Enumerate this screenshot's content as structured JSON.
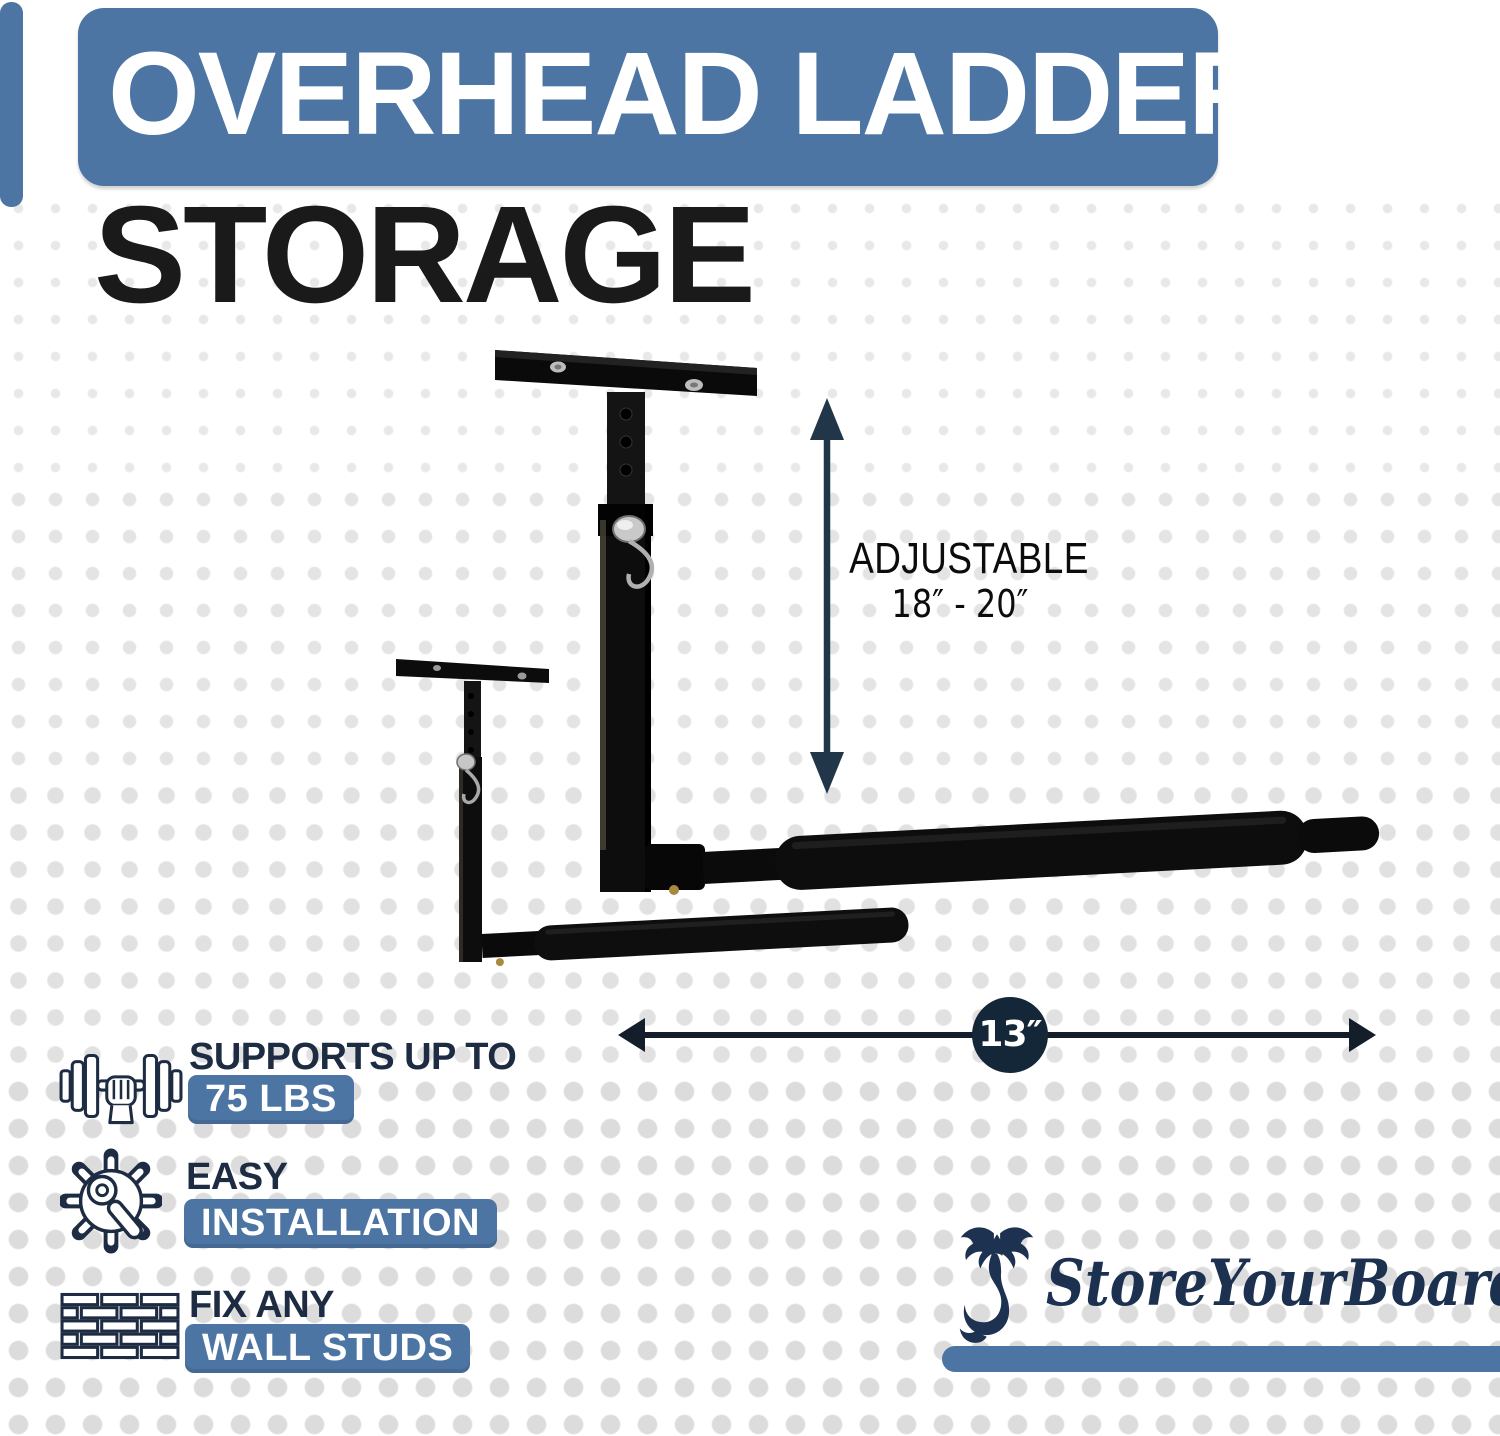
{
  "header": {
    "banner_title": "OVERHEAD LADDER",
    "subtitle": "STORAGE"
  },
  "dimensions": {
    "vertical_label": "ADJUSTABLE",
    "vertical_range": "18″ - 20″",
    "horizontal_value": "13″"
  },
  "features": [
    {
      "icon": "dumbbell-icon",
      "heading": "SUPPORTS UP TO",
      "badge": "75 LBS"
    },
    {
      "icon": "gear-wrench-icon",
      "heading": "EASY",
      "badge": "INSTALLATION"
    },
    {
      "icon": "brick-wall-icon",
      "heading": "FIX ANY",
      "badge": "WALL STUDS"
    }
  ],
  "brand": {
    "name": "StoreYourBoard",
    "icon": "scorpion-icon"
  },
  "colors": {
    "accent_blue": "#4d75a4",
    "navy_text": "#1d2c42",
    "badge_text_white": "#ffffff",
    "dimension_circle_navy": "#132738",
    "title_black": "#1a1a1a",
    "product_black": "#0d0d0d"
  }
}
